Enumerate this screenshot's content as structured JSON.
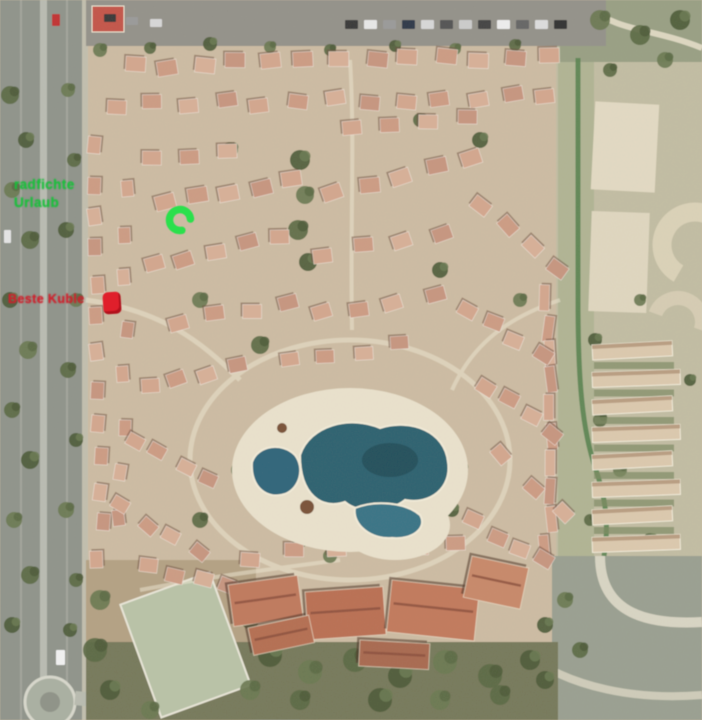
{
  "image_type": "satellite aerial photo of a resort complex",
  "annotations": {
    "green_label": {
      "line1": "radfichte",
      "line2": "Urlaub",
      "color": "#18c23a"
    },
    "red_label": {
      "text": "Beste Kuble",
      "color": "#d0202c"
    },
    "green_marker": {
      "shape": "open-ring",
      "color": "#2be04c"
    },
    "red_marker": {
      "shape": "rounded-square",
      "color": "#e01f2b"
    }
  },
  "scene_colors": {
    "ground": "#cdbca3",
    "roof": "#d2a58c",
    "hotel_roof": "#bd7357",
    "pool_water": "#2e6270",
    "pool_deck": "#eae2cd",
    "road": "#90948b",
    "vegetation": "#5c6a45",
    "sports_court": "#b9c3a7",
    "right_resort_buildings": "#dcc9ae"
  }
}
